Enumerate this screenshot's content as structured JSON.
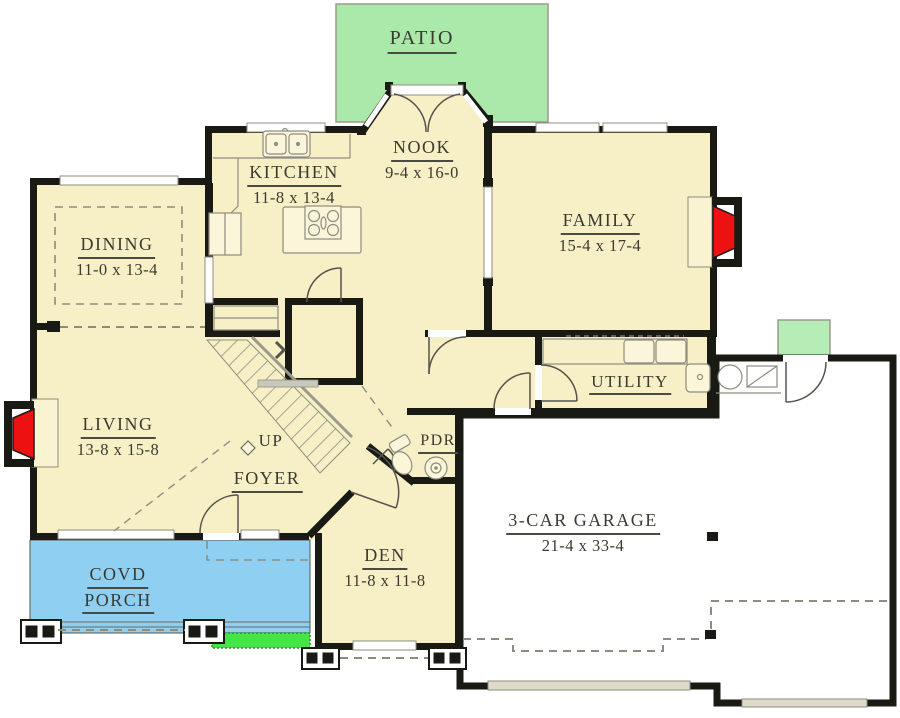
{
  "colors": {
    "floor-cream": "#f7f0c6",
    "patio-green": "#abe9ab",
    "porch-blue": "#8fd0f2",
    "step-green": "#44e544",
    "fire-red": "#ee1111",
    "wall-black": "#1a1a15",
    "line-gray": "#8d8d7f",
    "text-dark": "#3a3a30"
  },
  "rooms": {
    "patio": {
      "name": "PATIO"
    },
    "nook": {
      "name": "NOOK",
      "dims": "9-4 x 16-0"
    },
    "kitchen": {
      "name": "KITCHEN",
      "dims": "11-8 x 13-4"
    },
    "family": {
      "name": "FAMILY",
      "dims": "15-4 x 17-4"
    },
    "dining": {
      "name": "DINING",
      "dims": "11-0 x 13-4"
    },
    "living": {
      "name": "LIVING",
      "dims": "13-8 x 15-8"
    },
    "utility": {
      "name": "UTILITY"
    },
    "foyer": {
      "name": "FOYER"
    },
    "stairs": {
      "label": "UP"
    },
    "pdr": {
      "name": "PDR"
    },
    "den": {
      "name": "DEN",
      "dims": "11-8 x 11-8"
    },
    "porch": {
      "line1": "COVD",
      "line2": "PORCH"
    },
    "garage": {
      "name": "3-CAR GARAGE",
      "dims": "21-4 x 33-4"
    }
  }
}
